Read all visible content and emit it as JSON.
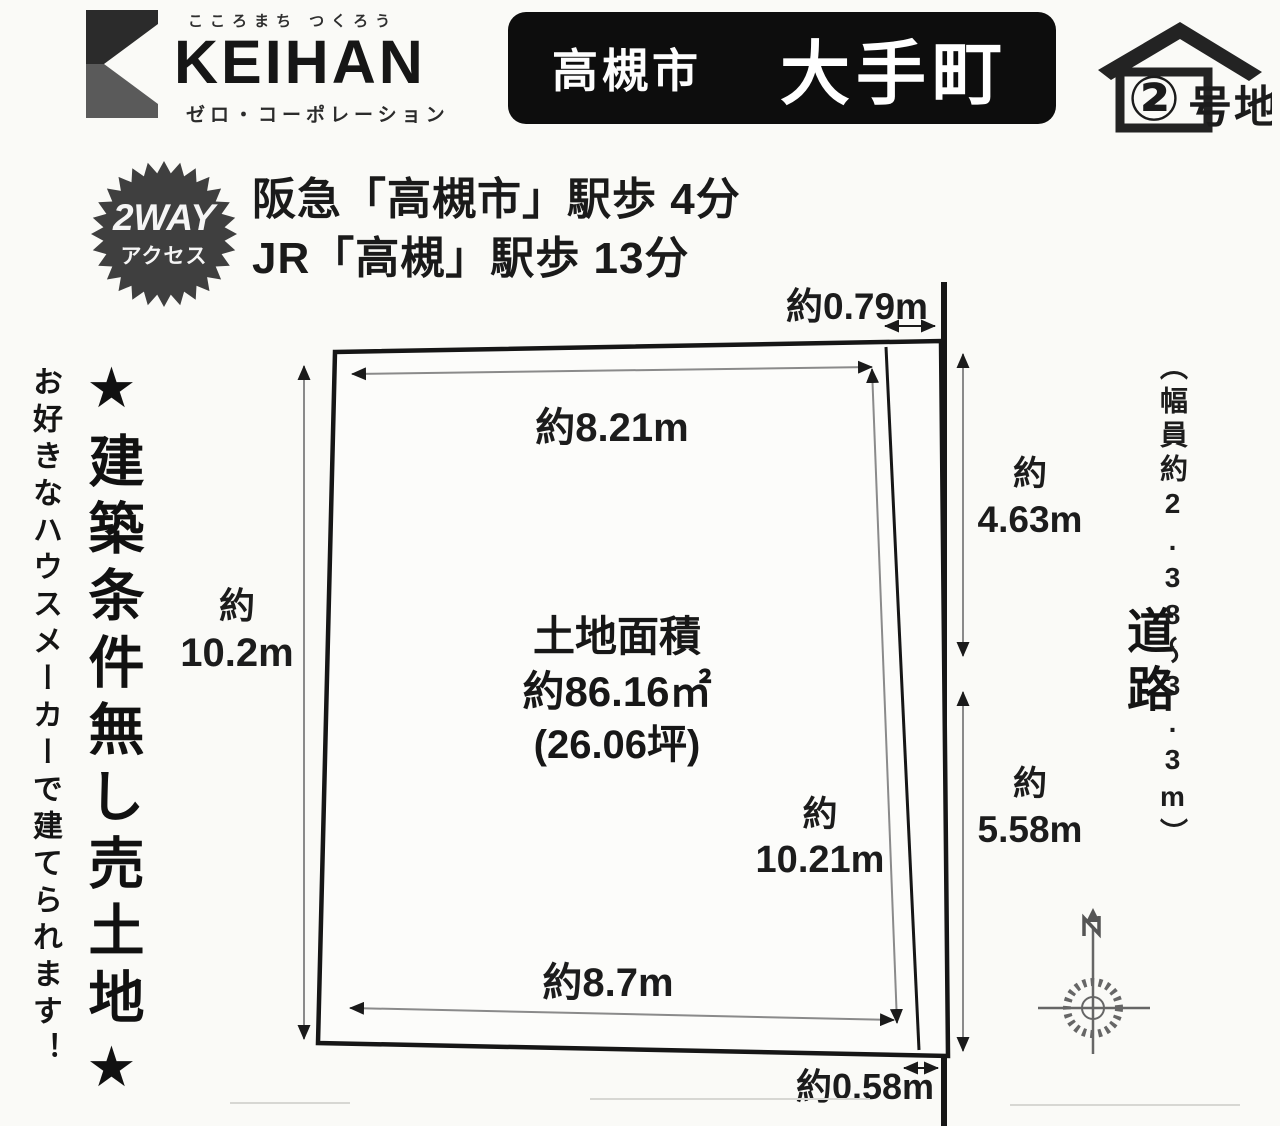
{
  "brand": {
    "tagline": "こころまち つくろう",
    "wordmark": "KEIHAN",
    "company": "ゼロ・コーポレーション"
  },
  "title": {
    "city": "高槻市",
    "district": "大手町"
  },
  "lot_badge": {
    "number_circled": "②",
    "suffix": "号地"
  },
  "access": {
    "badge_top": "2WAY",
    "badge_bottom": "アクセス",
    "hankyu_line": "阪急「高槻市」駅歩 4分",
    "jr_line": "JR「高槻」駅歩 13分"
  },
  "promo": {
    "main": "★建築条件無し売土地★",
    "sub": "お好きなハウスメーカーで建てられます！"
  },
  "plot": {
    "area_title": "土地面積",
    "area_sqm": "約86.16㎡",
    "area_tsubo": "(26.06坪)",
    "dim_top": "約8.21m",
    "dim_left_prefix": "約",
    "dim_left": "10.2m",
    "dim_top_right": "約0.79m",
    "dim_inner_prefix": "約",
    "dim_inner": "10.21m",
    "dim_right_upper_prefix": "約",
    "dim_right_upper": "4.63m",
    "dim_right_lower_prefix": "約",
    "dim_right_lower": "5.58m",
    "dim_bottom": "約8.7m",
    "dim_bottom_right": "約0.58m"
  },
  "road": {
    "name": "道路",
    "width_note": "（幅員約2.38〜3.3m）"
  },
  "colors": {
    "ink": "#1a1a1a",
    "paper": "#fafaf7",
    "banner_bg": "#0d0d0d",
    "badge_bg": "#3f3f3f",
    "outline": "#161616",
    "dim_line": "#8a8a8a",
    "compass": "#666666"
  }
}
